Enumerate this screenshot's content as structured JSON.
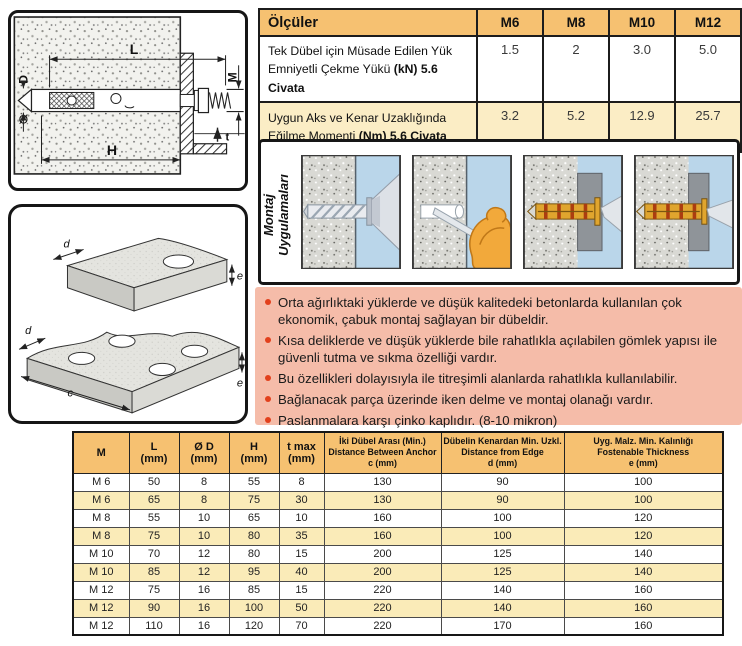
{
  "specs_table": {
    "title": "Ölçüler",
    "columns": [
      "M6",
      "M8",
      "M10",
      "M12"
    ],
    "rows": [
      {
        "label_l1": "Tek Dübel için Müsade Edilen Yük",
        "label_l2": "Emniyetli Çekme Yükü ",
        "label_l2_bold": "(kN) 5.6 Civata",
        "values": [
          "1.5",
          "2",
          "3.0",
          "5.0"
        ]
      },
      {
        "label_l1": "Uygun Aks ve Kenar Uzaklığında",
        "label_l2": "Eğilme Momenti ",
        "label_l2_bold": "(Nm)  5.6 Civata",
        "values": [
          "3.2",
          "5.2",
          "12.9",
          "25.7"
        ]
      }
    ]
  },
  "montaj": {
    "label_line1": "Montaj",
    "label_line2": "Uygulamaları",
    "steps": [
      "drill-hole",
      "clean-hole",
      "insert-anchor",
      "tighten-anchor"
    ]
  },
  "features": {
    "items": [
      "Orta ağırlıktaki yüklerde ve düşük kalitedeki betonlarda kullanılan çok ekonomik, çabuk montaj sağlayan bir dübeldir.",
      "Kısa deliklerde ve düşük yüklerde bile rahatlıkla açılabilen gömlek yapısı ile güvenli tutma ve sıkma özelliği vardır.",
      "Bu özellikleri dolayısıyla ile titreşimli alanlarda rahatlıkla kullanılabilir.",
      "Bağlanacak parça üzerinde iken delme ve montaj olanağı vardır.",
      "Paslanmalara karşı çinko kaplıdır. (8-10 mikron)"
    ]
  },
  "dimensions_table": {
    "headers": [
      {
        "lines": [
          "M"
        ]
      },
      {
        "lines": [
          "L",
          "(mm)"
        ]
      },
      {
        "lines": [
          "Ø D",
          "(mm)"
        ]
      },
      {
        "lines": [
          "H",
          "(mm)"
        ]
      },
      {
        "lines": [
          "t max",
          "(mm)"
        ]
      },
      {
        "lines": [
          "İki Dübel Arası (Min.)",
          "Distance Between Anchor",
          "c (mm)"
        ]
      },
      {
        "lines": [
          "Dübelin Kenardan Min. Uzkl.",
          "Distance from Edge",
          "d (mm)"
        ]
      },
      {
        "lines": [
          "Uyg. Malz. Min. Kalınlığı",
          "Fostenable Thickness",
          "e (mm)"
        ]
      }
    ],
    "rows": [
      [
        "M 6",
        "50",
        "8",
        "55",
        "8",
        "130",
        "90",
        "100"
      ],
      [
        "M 6",
        "65",
        "8",
        "75",
        "30",
        "130",
        "90",
        "100"
      ],
      [
        "M 8",
        "55",
        "10",
        "65",
        "10",
        "160",
        "100",
        "120"
      ],
      [
        "M 8",
        "75",
        "10",
        "80",
        "35",
        "160",
        "100",
        "120"
      ],
      [
        "M 10",
        "70",
        "12",
        "80",
        "15",
        "200",
        "125",
        "140"
      ],
      [
        "M 10",
        "85",
        "12",
        "95",
        "40",
        "200",
        "125",
        "140"
      ],
      [
        "M 12",
        "75",
        "16",
        "85",
        "15",
        "220",
        "140",
        "160"
      ],
      [
        "M 12",
        "90",
        "16",
        "100",
        "50",
        "220",
        "140",
        "160"
      ],
      [
        "M 12",
        "110",
        "16",
        "120",
        "70",
        "220",
        "170",
        "160"
      ]
    ]
  },
  "anchor_drawing": {
    "labels": {
      "L": "L",
      "M": "M",
      "D": "D",
      "diameter": "Ø",
      "H": "H",
      "t": "t"
    }
  },
  "plate_drawing": {
    "labels": {
      "d": "d",
      "e": "e",
      "c": "c"
    }
  },
  "colors": {
    "table_header_orange": "#F6C171",
    "row_yellow": "#FAEBB8",
    "row_cream": "#FBEDC5",
    "features_pink": "#F5BCA9",
    "bullet_red": "#E2401C",
    "panel_blue": "#BAD6EA",
    "anchor_gold": "#E0A52E"
  }
}
